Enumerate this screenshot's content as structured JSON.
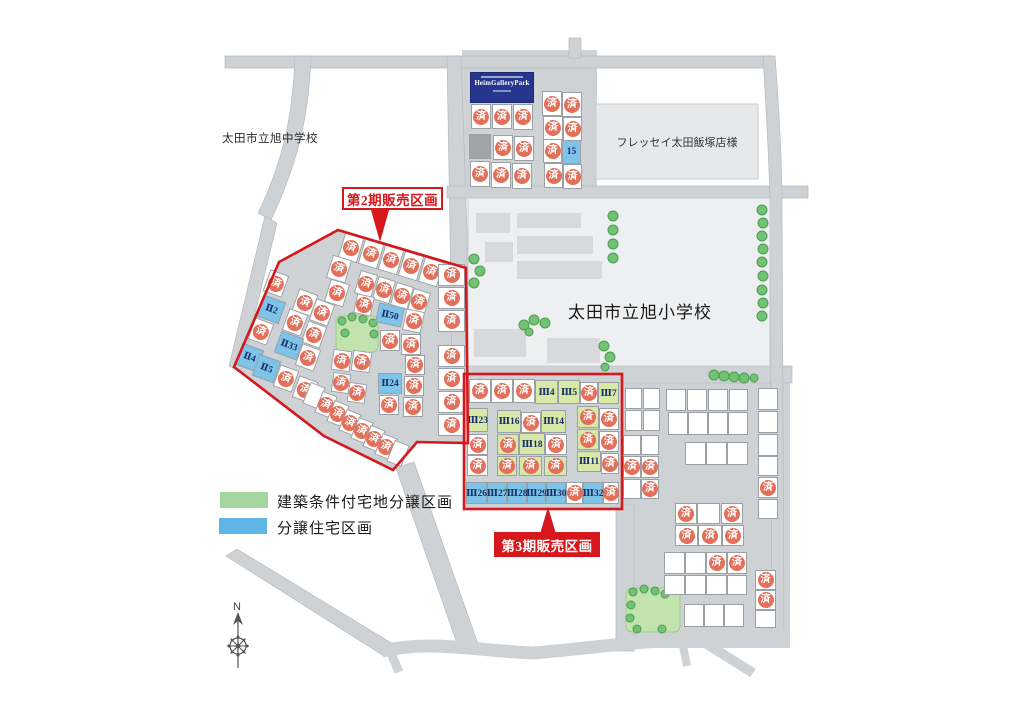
{
  "map_labels": {
    "junior_high_school": "太田市立旭中学校",
    "elementary_school": "太田市立旭小学校",
    "supermarket": "フレッセイ太田飯塚店様",
    "sign_title": "HeimGalleryPark"
  },
  "phase_labels": {
    "phase2": "第2期販売区画",
    "phase3": "第3期販売区画"
  },
  "legend": {
    "items": [
      {
        "label": "建築条件付宅地分譲区画",
        "color": "#a5d6a0"
      },
      {
        "label": "分譲住宅区画",
        "color": "#5db6e4"
      }
    ]
  },
  "sold_mark": "済",
  "compass": {
    "north": "N"
  },
  "colors": {
    "red": "#d6171c",
    "road": "#cfd2d5",
    "sold_circle": "#e2705a",
    "blue_lot": "#7ec4e8",
    "green_lot": "#d8e8a6",
    "legend_green": "#a5d6a0",
    "legend_blue": "#5db6e4"
  },
  "lots": [
    [
      471,
      104,
      20,
      25,
      "s"
    ],
    [
      492,
      104,
      20,
      25,
      "s"
    ],
    [
      513,
      104,
      20,
      26,
      "s"
    ],
    [
      469,
      134,
      22,
      25,
      "gray"
    ],
    [
      493,
      135,
      20,
      25,
      "s"
    ],
    [
      514,
      136,
      20,
      25,
      "s"
    ],
    [
      470,
      161,
      20,
      26,
      "s"
    ],
    [
      491,
      162,
      20,
      26,
      "s"
    ],
    [
      512,
      163,
      20,
      26,
      "s"
    ],
    [
      542,
      91,
      20,
      25,
      "s"
    ],
    [
      562,
      92,
      20,
      25,
      "s"
    ],
    [
      543,
      116,
      20,
      24,
      "s"
    ],
    [
      563,
      117,
      19,
      24,
      "s"
    ],
    [
      543,
      139,
      19,
      24,
      "s"
    ],
    [
      562,
      140,
      19,
      24,
      "b",
      0,
      "15"
    ],
    [
      544,
      163,
      19,
      25,
      "s"
    ],
    [
      563,
      164,
      19,
      25,
      "s"
    ],
    [
      341,
      235,
      20,
      26,
      "s",
      17
    ],
    [
      361,
      241,
      20,
      26,
      "s",
      17
    ],
    [
      381,
      247,
      20,
      26,
      "s",
      17
    ],
    [
      401,
      253,
      20,
      26,
      "s",
      17
    ],
    [
      421,
      259,
      20,
      26,
      "s",
      17
    ],
    [
      329,
      257,
      20,
      24,
      "s",
      17
    ],
    [
      327,
      281,
      20,
      24,
      "s",
      17
    ],
    [
      357,
      272,
      18,
      24,
      "s",
      17
    ],
    [
      375,
      278,
      18,
      24,
      "s",
      17
    ],
    [
      393,
      284,
      18,
      24,
      "s",
      17
    ],
    [
      410,
      290,
      18,
      24,
      "s",
      17
    ],
    [
      355,
      295,
      18,
      20,
      "s",
      12
    ],
    [
      377,
      305,
      26,
      20,
      "b",
      12,
      "Ⅱ50"
    ],
    [
      404,
      310,
      19,
      22,
      "s",
      12
    ],
    [
      438,
      264,
      27,
      22,
      "s"
    ],
    [
      438,
      287,
      27,
      22,
      "s"
    ],
    [
      438,
      310,
      27,
      22,
      "s"
    ],
    [
      438,
      345,
      27,
      22,
      "s"
    ],
    [
      438,
      368,
      27,
      22,
      "s"
    ],
    [
      438,
      391,
      27,
      22,
      "s"
    ],
    [
      438,
      414,
      27,
      22,
      "s"
    ],
    [
      266,
      272,
      20,
      23,
      "s",
      20
    ],
    [
      260,
      298,
      23,
      23,
      "b",
      20,
      "Ⅱ2"
    ],
    [
      251,
      320,
      20,
      23,
      "s",
      20
    ],
    [
      295,
      291,
      20,
      23,
      "s",
      20
    ],
    [
      312,
      301,
      20,
      23,
      "s",
      20
    ],
    [
      285,
      311,
      20,
      23,
      "s",
      20
    ],
    [
      304,
      323,
      20,
      23,
      "s",
      20
    ],
    [
      277,
      334,
      24,
      23,
      "b",
      20,
      "Ⅱ33"
    ],
    [
      298,
      346,
      20,
      23,
      "s",
      20
    ],
    [
      238,
      346,
      23,
      23,
      "b",
      20,
      "Ⅱ4"
    ],
    [
      255,
      357,
      23,
      23,
      "b",
      20,
      "Ⅱ5"
    ],
    [
      276,
      367,
      20,
      23,
      "s",
      20
    ],
    [
      295,
      378,
      20,
      23,
      "s",
      20
    ],
    [
      332,
      350,
      19,
      21,
      "s",
      8
    ],
    [
      352,
      351,
      19,
      21,
      "s",
      8
    ],
    [
      332,
      373,
      18,
      20,
      "s",
      8
    ],
    [
      348,
      383,
      18,
      20,
      "s",
      8
    ],
    [
      380,
      330,
      20,
      21,
      "s"
    ],
    [
      401,
      334,
      20,
      21,
      "s"
    ],
    [
      405,
      355,
      20,
      20,
      "s"
    ],
    [
      378,
      373,
      24,
      21,
      "b",
      0,
      "Ⅱ24"
    ],
    [
      404,
      376,
      20,
      20,
      "s"
    ],
    [
      379,
      395,
      20,
      20,
      "s"
    ],
    [
      403,
      397,
      20,
      20,
      "s"
    ],
    [
      306,
      384,
      16,
      23,
      "w",
      22
    ],
    [
      318,
      393,
      16,
      23,
      "s",
      22
    ],
    [
      330,
      402,
      16,
      23,
      "s",
      22
    ],
    [
      342,
      411,
      16,
      23,
      "s",
      22
    ],
    [
      354,
      419,
      16,
      23,
      "s",
      22
    ],
    [
      366,
      427,
      16,
      23,
      "s",
      22
    ],
    [
      378,
      435,
      16,
      23,
      "s",
      22
    ],
    [
      390,
      442,
      16,
      23,
      "w",
      22
    ],
    [
      469,
      379,
      22,
      24,
      "s"
    ],
    [
      491,
      379,
      22,
      24,
      "s"
    ],
    [
      513,
      379,
      22,
      24,
      "s"
    ],
    [
      535,
      380,
      23,
      24,
      "g",
      0,
      "Ⅲ4"
    ],
    [
      558,
      380,
      22,
      24,
      "g",
      0,
      "Ⅲ5"
    ],
    [
      580,
      382,
      18,
      22,
      "s"
    ],
    [
      598,
      382,
      21,
      22,
      "g",
      0,
      "Ⅲ7"
    ],
    [
      467,
      408,
      21,
      24,
      "g",
      0,
      "Ⅲ23"
    ],
    [
      467,
      434,
      21,
      21,
      "s"
    ],
    [
      467,
      455,
      21,
      21,
      "s"
    ],
    [
      497,
      410,
      24,
      23,
      "g",
      0,
      "Ⅲ16"
    ],
    [
      521,
      412,
      20,
      21,
      "s"
    ],
    [
      541,
      410,
      25,
      23,
      "g",
      0,
      "Ⅲ14"
    ],
    [
      497,
      434,
      22,
      21,
      "gs"
    ],
    [
      519,
      433,
      26,
      22,
      "g",
      0,
      "Ⅲ18"
    ],
    [
      545,
      434,
      22,
      21,
      "s"
    ],
    [
      497,
      456,
      20,
      20,
      "gs"
    ],
    [
      519,
      456,
      23,
      20,
      "gs"
    ],
    [
      544,
      456,
      23,
      20,
      "gs"
    ],
    [
      577,
      406,
      22,
      22,
      "gs"
    ],
    [
      599,
      408,
      20,
      22,
      "s"
    ],
    [
      577,
      429,
      22,
      21,
      "gs"
    ],
    [
      599,
      431,
      20,
      21,
      "s"
    ],
    [
      577,
      451,
      24,
      21,
      "g",
      0,
      "Ⅲ11"
    ],
    [
      601,
      453,
      18,
      21,
      "s"
    ],
    [
      466,
      482,
      21,
      22,
      "b",
      0,
      "Ⅲ26"
    ],
    [
      487,
      482,
      20,
      22,
      "b",
      0,
      "Ⅲ27"
    ],
    [
      507,
      482,
      20,
      22,
      "b",
      0,
      "Ⅲ28"
    ],
    [
      527,
      482,
      19,
      22,
      "b",
      0,
      "Ⅲ29"
    ],
    [
      546,
      482,
      20,
      22,
      "b",
      0,
      "Ⅲ30"
    ],
    [
      566,
      482,
      17,
      22,
      "s"
    ],
    [
      583,
      482,
      20,
      22,
      "b",
      0,
      "Ⅲ32"
    ],
    [
      603,
      482,
      16,
      22,
      "s"
    ],
    [
      625,
      388,
      17,
      21,
      "w"
    ],
    [
      643,
      388,
      17,
      21,
      "w"
    ],
    [
      625,
      410,
      17,
      21,
      "w"
    ],
    [
      643,
      410,
      17,
      21,
      "w"
    ],
    [
      666,
      389,
      20,
      22,
      "w"
    ],
    [
      687,
      389,
      20,
      22,
      "w"
    ],
    [
      708,
      389,
      20,
      22,
      "w"
    ],
    [
      729,
      389,
      19,
      22,
      "w"
    ],
    [
      758,
      388,
      20,
      22,
      "w"
    ],
    [
      758,
      411,
      20,
      22,
      "w"
    ],
    [
      758,
      434,
      20,
      22,
      "w"
    ],
    [
      758,
      456,
      20,
      20,
      "w"
    ],
    [
      758,
      477,
      20,
      21,
      "s"
    ],
    [
      758,
      499,
      20,
      20,
      "w"
    ],
    [
      668,
      412,
      20,
      23,
      "w"
    ],
    [
      688,
      412,
      20,
      23,
      "w"
    ],
    [
      708,
      412,
      20,
      23,
      "w"
    ],
    [
      728,
      412,
      20,
      23,
      "w"
    ],
    [
      623,
      435,
      18,
      20,
      "w"
    ],
    [
      641,
      435,
      18,
      20,
      "w"
    ],
    [
      623,
      456,
      18,
      22,
      "s"
    ],
    [
      641,
      456,
      18,
      22,
      "s"
    ],
    [
      623,
      479,
      18,
      20,
      "w"
    ],
    [
      641,
      479,
      18,
      20,
      "s"
    ],
    [
      685,
      442,
      21,
      23,
      "w"
    ],
    [
      706,
      442,
      21,
      23,
      "w"
    ],
    [
      727,
      442,
      21,
      23,
      "w"
    ],
    [
      675,
      503,
      22,
      21,
      "s"
    ],
    [
      697,
      503,
      23,
      21,
      "w"
    ],
    [
      721,
      503,
      22,
      21,
      "s"
    ],
    [
      675,
      525,
      23,
      21,
      "s"
    ],
    [
      698,
      525,
      24,
      21,
      "s"
    ],
    [
      722,
      525,
      22,
      21,
      "s"
    ],
    [
      664,
      552,
      21,
      22,
      "w"
    ],
    [
      685,
      552,
      21,
      22,
      "w"
    ],
    [
      706,
      552,
      21,
      22,
      "s"
    ],
    [
      727,
      552,
      20,
      22,
      "s"
    ],
    [
      664,
      575,
      21,
      20,
      "w"
    ],
    [
      685,
      575,
      21,
      20,
      "w"
    ],
    [
      706,
      575,
      21,
      20,
      "w"
    ],
    [
      727,
      575,
      20,
      20,
      "w"
    ],
    [
      755,
      570,
      21,
      20,
      "s"
    ],
    [
      755,
      590,
      21,
      20,
      "s"
    ],
    [
      755,
      610,
      21,
      18,
      "w"
    ],
    [
      684,
      604,
      20,
      23,
      "w"
    ],
    [
      704,
      604,
      20,
      23,
      "w"
    ],
    [
      724,
      604,
      20,
      23,
      "w"
    ]
  ]
}
